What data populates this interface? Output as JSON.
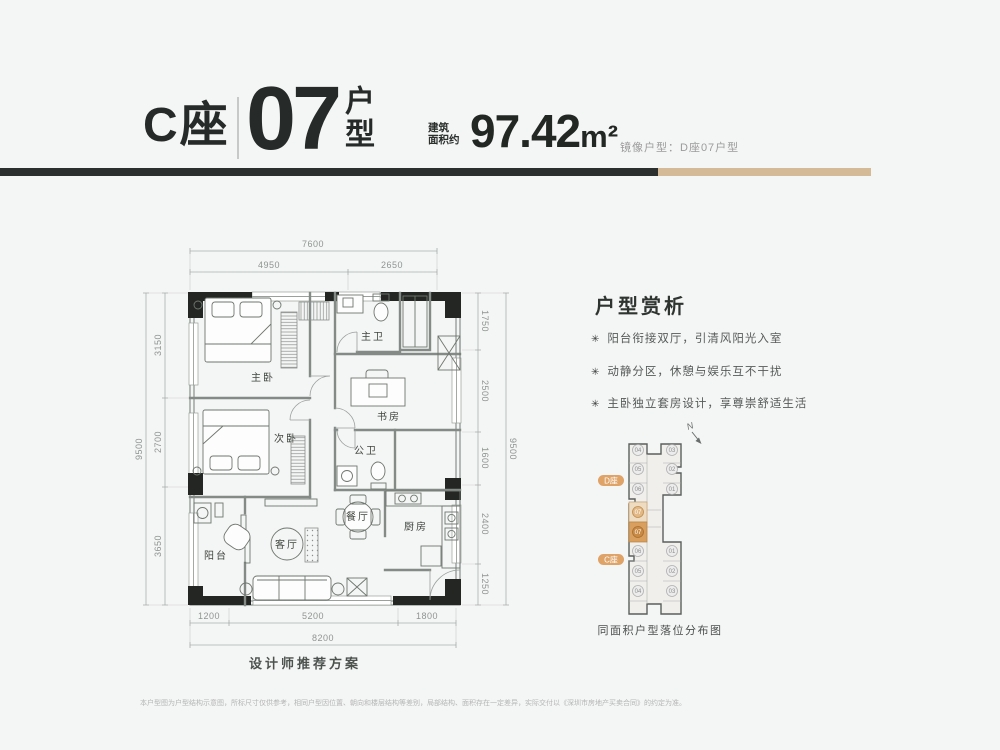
{
  "header": {
    "building": "C座",
    "unit_number": "07",
    "unit_type": "户型",
    "area_label_line1": "建筑",
    "area_label_line2": "面积约",
    "area_value": "97.42",
    "area_unit": "m²",
    "mirror_note": "镜像户型：D座07户型"
  },
  "colors": {
    "dark": "#2b302e",
    "tan": "#d5ba98",
    "highlight_light": "#eedcc2",
    "highlight_dark": "#d89f5f",
    "pill": "#dfa368"
  },
  "floorplan": {
    "caption": "设计师推荐方案",
    "rooms": {
      "master_bedroom": "主卧",
      "second_bedroom": "次卧",
      "master_bath": "主卫",
      "study": "书房",
      "guest_bath": "公卫",
      "dining": "餐厅",
      "kitchen": "厨房",
      "living": "客厅",
      "balcony": "阳台"
    },
    "dimensions": {
      "top_total": "7600",
      "top_left": "4950",
      "top_right": "2650",
      "left_total": "9500",
      "left_segments": [
        "3150",
        "2700",
        "3650"
      ],
      "right_total": "9500",
      "right_segments": [
        "1750",
        "2500",
        "1600",
        "2400",
        "1250"
      ],
      "bottom_total": "8200",
      "bottom_segments": [
        "1200",
        "5200",
        "1800"
      ]
    }
  },
  "analysis": {
    "title": "户型赏析",
    "bullet_icon": "✳",
    "points": [
      "阳台衔接双厅，引清风阳光入室",
      "动静分区，休憩与娱乐互不干扰",
      "主卧独立套房设计，享尊崇舒适生活"
    ]
  },
  "locator": {
    "north_label": "N",
    "d_label": "D座",
    "c_label": "C座",
    "d_left_units": [
      "04",
      "05",
      "06"
    ],
    "d_right_units": [
      "03",
      "02",
      "01"
    ],
    "d_highlight": "07",
    "c_left_units": [
      "06",
      "05",
      "04"
    ],
    "c_right_units": [
      "01",
      "02",
      "03"
    ],
    "c_highlight": "07",
    "caption": "同面积户型落位分布图"
  },
  "disclaimer": "本户型图为户型结构示意图，所标尺寸仅供参考，相同户型因位置、朝向和楼层结构等差别，局部结构、面积存在一定差异，实际交付以《深圳市房地产买卖合同》的约定为准。"
}
